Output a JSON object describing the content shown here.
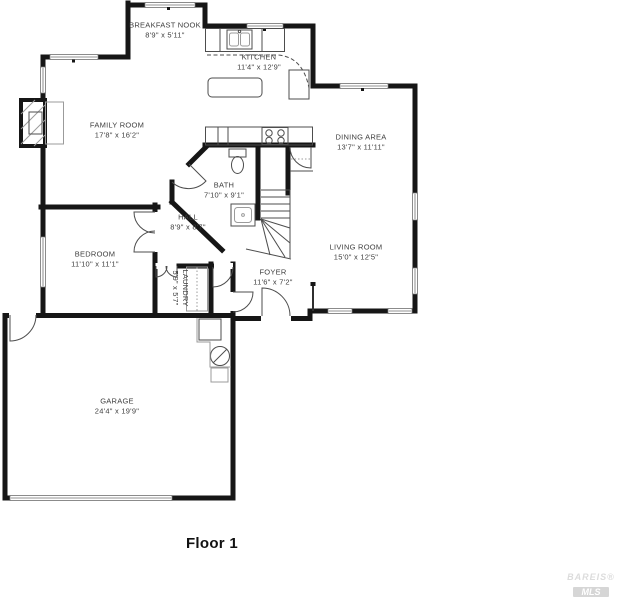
{
  "title": "Floor 1",
  "watermark": {
    "line1": "BAREIS®",
    "line2": "MLS"
  },
  "colors": {
    "wall": "#161616",
    "thin": "#4d4d4d",
    "light": "#9b9b9b",
    "window_border": "#6f6f6f"
  },
  "rooms": [
    {
      "name": "BREAKFAST NOOK",
      "dims": "8'9\" x 5'11\"",
      "cx": 165,
      "cy": 30,
      "vertical": false
    },
    {
      "name": "KITCHEN",
      "dims": "11'4\" x 12'9\"",
      "cx": 259,
      "cy": 62,
      "vertical": false
    },
    {
      "name": "FAMILY ROOM",
      "dims": "17'8\" x 16'2\"",
      "cx": 117,
      "cy": 130,
      "vertical": false
    },
    {
      "name": "DINING AREA",
      "dims": "13'7\" x 11'11\"",
      "cx": 361,
      "cy": 142,
      "vertical": false
    },
    {
      "name": "BATH",
      "dims": "7'10\" x 9'1\"",
      "cx": 224,
      "cy": 190,
      "vertical": false
    },
    {
      "name": "HALL",
      "dims": "8'9\" x 8'7\"",
      "cx": 188,
      "cy": 222,
      "vertical": false
    },
    {
      "name": "BEDROOM",
      "dims": "11'10\" x 11'1\"",
      "cx": 95,
      "cy": 259,
      "vertical": false
    },
    {
      "name": "LIVING ROOM",
      "dims": "15'0\" x 12'5\"",
      "cx": 356,
      "cy": 252,
      "vertical": false
    },
    {
      "name": "FOYER",
      "dims": "11'6\" x 7'2\"",
      "cx": 273,
      "cy": 277,
      "vertical": false
    },
    {
      "name": "LAUNDRY",
      "dims": "5'9\" x 5'7\"",
      "cx": 180,
      "cy": 288,
      "vertical": true
    },
    {
      "name": "GARAGE",
      "dims": "24'4\" x 19'9\"",
      "cx": 117,
      "cy": 406,
      "vertical": false
    }
  ],
  "floorplan": {
    "shapes": [
      {
        "k": "pl",
        "c": "wall",
        "p": "128,5 205,5 205,26 313,26 313,86 415,86 415,311 310,311 310,318.5 233,318.5"
      },
      {
        "k": "pl",
        "c": "wall",
        "p": "233,318.5 233,498 5,498 5,315.5 233,315.5"
      },
      {
        "k": "pl",
        "c": "wall",
        "p": "128,3 128,57 43,57 43,315"
      },
      {
        "k": "ln",
        "c": "wall",
        "x1": 41,
        "y1": 207,
        "x2": 158,
        "y2": 207
      },
      {
        "k": "ln",
        "c": "wall",
        "x1": 155,
        "y1": 205,
        "x2": 155,
        "y2": 212
      },
      {
        "k": "ln",
        "c": "wall",
        "x1": 155,
        "y1": 252,
        "x2": 155,
        "y2": 315
      },
      {
        "k": "ln",
        "c": "wall",
        "x1": 177,
        "y1": 266,
        "x2": 213,
        "y2": 266
      },
      {
        "k": "ln",
        "c": "wall",
        "x1": 211,
        "y1": 264,
        "x2": 211,
        "y2": 315
      },
      {
        "k": "ln",
        "c": "wall",
        "x1": 233,
        "y1": 264,
        "x2": 233,
        "y2": 318
      },
      {
        "k": "ln",
        "c": "wall",
        "x1": 205,
        "y1": 145,
        "x2": 313,
        "y2": 145
      },
      {
        "k": "ln",
        "c": "wall",
        "x1": 258,
        "y1": 145,
        "x2": 258,
        "y2": 218
      },
      {
        "k": "ln",
        "c": "wall",
        "x1": 288,
        "y1": 145,
        "x2": 288,
        "y2": 193
      },
      {
        "k": "ln",
        "c": "wall",
        "x1": 206,
        "y1": 147,
        "x2": 189,
        "y2": 164
      },
      {
        "k": "ln",
        "c": "wall",
        "x1": 172,
        "y1": 182,
        "x2": 172,
        "y2": 202
      },
      {
        "k": "ln",
        "c": "wall",
        "x1": 172,
        "y1": 202,
        "x2": 222,
        "y2": 250
      },
      {
        "k": "wh",
        "x": 261,
        "y": 315,
        "w": 30,
        "h": 7
      },
      {
        "k": "wh",
        "x": 9,
        "y": 312,
        "w": 27,
        "h": 7
      },
      {
        "k": "wh",
        "x": 152,
        "y": 212,
        "w": 6,
        "h": 40
      },
      {
        "k": "wh",
        "x": 155.5,
        "y": 263,
        "w": 21,
        "h": 6
      },
      {
        "k": "wh",
        "x": 214,
        "y": 263,
        "w": 19,
        "h": 6
      },
      {
        "k": "wh",
        "x": 230,
        "y": 292,
        "w": 6,
        "h": 19
      },
      {
        "k": "wn",
        "x": 145,
        "y": 2.5,
        "w": 50,
        "h": 5
      },
      {
        "k": "wn",
        "x": 247,
        "y": 23.5,
        "w": 36,
        "h": 5
      },
      {
        "k": "wn",
        "x": 340,
        "y": 83.5,
        "w": 48,
        "h": 5
      },
      {
        "k": "wn",
        "x": 412.5,
        "y": 193,
        "w": 5,
        "h": 27
      },
      {
        "k": "wn",
        "x": 412.5,
        "y": 268,
        "w": 5,
        "h": 26
      },
      {
        "k": "wn",
        "x": 328,
        "y": 308.5,
        "w": 24,
        "h": 5
      },
      {
        "k": "wn",
        "x": 388,
        "y": 308.5,
        "w": 24,
        "h": 5
      },
      {
        "k": "wn",
        "x": 50,
        "y": 54.5,
        "w": 48,
        "h": 5
      },
      {
        "k": "wn",
        "x": 40.5,
        "y": 67,
        "w": 5,
        "h": 26
      },
      {
        "k": "wn",
        "x": 40.5,
        "y": 237,
        "w": 5,
        "h": 50
      },
      {
        "k": "wn",
        "x": 10,
        "y": 495.5,
        "w": 162,
        "h": 5
      },
      {
        "k": "rc",
        "c": "blk",
        "x": 167,
        "y": 7,
        "w": 3,
        "h": 3
      },
      {
        "k": "rc",
        "c": "blk",
        "x": 72,
        "y": 59.5,
        "w": 3,
        "h": 3
      },
      {
        "k": "rc",
        "c": "blk",
        "x": 263,
        "y": 28,
        "w": 3,
        "h": 3
      },
      {
        "k": "rc",
        "c": "blk",
        "x": 361,
        "y": 88,
        "w": 3,
        "h": 3
      },
      {
        "k": "pa",
        "c": "thin",
        "d": "M262,316 L262,288 A28,28 0 0 1 290,316"
      },
      {
        "k": "pa",
        "c": "thin",
        "d": "M10,315 L10,341 A26,26 0 0 0 36,315"
      },
      {
        "k": "pa",
        "c": "thin",
        "d": "M155,212 L134,212 A21,21 0 0 0 155,233"
      },
      {
        "k": "pa",
        "c": "thin",
        "d": "M155,252 L134,252 A21,21 0 0 1 155,231"
      },
      {
        "k": "pa",
        "c": "thin",
        "d": "M156,266 L156,277 A11,11 0 0 0 167,266"
      },
      {
        "k": "pa",
        "c": "thin",
        "d": "M177,266 L177,277 A11,11 0 0 1 166,266"
      },
      {
        "k": "pa",
        "c": "thin",
        "d": "M213,267 L213,287 A20,20 0 0 0 233,267"
      },
      {
        "k": "pa",
        "c": "thin",
        "d": "M233,292 L253,292 A20,20 0 0 1 233,312"
      },
      {
        "k": "pa",
        "c": "thin",
        "d": "M189,164 L206,181 A24,24 0 0 1 172,182"
      },
      {
        "k": "pa",
        "c": "thin",
        "d": "M311,147 L311,168 A21,21 0 0 1 290,147"
      },
      {
        "k": "ln",
        "c": "thin",
        "x1": 261,
        "y1": 190,
        "x2": 290,
        "y2": 190
      },
      {
        "k": "ln",
        "c": "thin",
        "x1": 261,
        "y1": 197,
        "x2": 290,
        "y2": 197
      },
      {
        "k": "ln",
        "c": "thin",
        "x1": 261,
        "y1": 204,
        "x2": 290,
        "y2": 204
      },
      {
        "k": "ln",
        "c": "thin",
        "x1": 261,
        "y1": 211,
        "x2": 290,
        "y2": 211
      },
      {
        "k": "ln",
        "c": "thin",
        "x1": 261,
        "y1": 218,
        "x2": 290,
        "y2": 218
      },
      {
        "k": "ln",
        "c": "thin",
        "x1": 290,
        "y1": 190,
        "x2": 290,
        "y2": 258
      },
      {
        "k": "ln",
        "c": "thin",
        "x1": 246,
        "y1": 249,
        "x2": 291,
        "y2": 259
      },
      {
        "k": "ln",
        "c": "thin",
        "x1": 261,
        "y1": 219,
        "x2": 290,
        "y2": 228
      },
      {
        "k": "ln",
        "c": "thin",
        "x1": 261,
        "y1": 219,
        "x2": 290,
        "y2": 243
      },
      {
        "k": "ln",
        "c": "thin",
        "x1": 261,
        "y1": 219,
        "x2": 285,
        "y2": 257
      },
      {
        "k": "ln",
        "c": "thin",
        "x1": 261,
        "y1": 219,
        "x2": 270,
        "y2": 255
      },
      {
        "k": "ln",
        "c": "thin",
        "x1": 290,
        "y1": 171,
        "x2": 313,
        "y2": 171
      },
      {
        "k": "ln",
        "c": "dot",
        "x1": 291,
        "y1": 159,
        "x2": 312,
        "y2": 159
      },
      {
        "k": "ln",
        "c": "med",
        "x1": 313,
        "y1": 285,
        "x2": 313,
        "y2": 311
      },
      {
        "k": "rc",
        "c": "blk",
        "x": 310.5,
        "y": 282,
        "w": 5,
        "h": 4
      },
      {
        "k": "rc",
        "c": "thin",
        "x": 205.5,
        "y": 28.5,
        "w": 79,
        "h": 23
      },
      {
        "k": "ln",
        "c": "thin",
        "x1": 220,
        "y1": 28.5,
        "x2": 220,
        "y2": 51.5
      },
      {
        "k": "ln",
        "c": "thin",
        "x1": 262,
        "y1": 28.5,
        "x2": 262,
        "y2": 51.5
      },
      {
        "k": "rc",
        "c": "thin",
        "x": 227,
        "y": 30,
        "w": 25,
        "h": 19
      },
      {
        "k": "rc",
        "c": "light",
        "x": 229.5,
        "y": 33,
        "w": 9,
        "h": 13,
        "rx": 2
      },
      {
        "k": "rc",
        "c": "light",
        "x": 240.5,
        "y": 33,
        "w": 9,
        "h": 13,
        "rx": 2
      },
      {
        "k": "ci",
        "c": "thin",
        "cx": 239.5,
        "cy": 31.5,
        "r": 1.2
      },
      {
        "k": "pa",
        "c": "dash",
        "d": "M207,55 L278,55 Q303,57 309,88"
      },
      {
        "k": "rc",
        "c": "thin",
        "x": 289,
        "y": 70,
        "w": 20,
        "h": 29
      },
      {
        "k": "rc",
        "c": "thin",
        "x": 208,
        "y": 78,
        "w": 54,
        "h": 19,
        "rx": 4
      },
      {
        "k": "rc",
        "c": "thin",
        "x": 205.5,
        "y": 127,
        "w": 107,
        "h": 18
      },
      {
        "k": "ln",
        "c": "thin",
        "x1": 218,
        "y1": 127,
        "x2": 218,
        "y2": 145
      },
      {
        "k": "ln",
        "c": "thin",
        "x1": 228,
        "y1": 127,
        "x2": 228,
        "y2": 145
      },
      {
        "k": "rc",
        "c": "thin",
        "x": 262,
        "y": 127.5,
        "w": 26,
        "h": 17
      },
      {
        "k": "ci",
        "c": "thin",
        "cx": 269,
        "cy": 133,
        "r": 3.2
      },
      {
        "k": "ci",
        "c": "thin",
        "cx": 281,
        "cy": 133,
        "r": 3.2
      },
      {
        "k": "ci",
        "c": "thin",
        "cx": 269,
        "cy": 140.5,
        "r": 3.2
      },
      {
        "k": "ci",
        "c": "thin",
        "cx": 281,
        "cy": 140.5,
        "r": 3.2
      },
      {
        "k": "rc",
        "c": "thin",
        "x": 229,
        "y": 149,
        "w": 17,
        "h": 8
      },
      {
        "k": "el",
        "c": "thin",
        "cx": 237.5,
        "cy": 165,
        "rx": 6,
        "ry": 8.5
      },
      {
        "k": "rc",
        "c": "thin",
        "x": 231,
        "y": 204,
        "w": 24,
        "h": 22
      },
      {
        "k": "rc",
        "c": "light",
        "x": 234.5,
        "y": 207.5,
        "w": 17,
        "h": 15,
        "rx": 3
      },
      {
        "k": "ci",
        "c": "light",
        "cx": 243,
        "cy": 215,
        "r": 1.4
      },
      {
        "k": "rc",
        "c": "light",
        "x": 186.5,
        "y": 267,
        "w": 21,
        "h": 44
      },
      {
        "k": "ln",
        "c": "dot",
        "x1": 197,
        "y1": 267,
        "x2": 197,
        "y2": 311
      },
      {
        "k": "rc",
        "c": "wall4",
        "x": 21,
        "y": 100,
        "w": 24,
        "h": 46
      },
      {
        "k": "ln",
        "c": "light",
        "x1": 21,
        "y1": 114,
        "x2": 35,
        "y2": 100
      },
      {
        "k": "ln",
        "c": "light",
        "x1": 21,
        "y1": 129,
        "x2": 45,
        "y2": 105
      },
      {
        "k": "ln",
        "c": "light",
        "x1": 21,
        "y1": 144,
        "x2": 45,
        "y2": 120
      },
      {
        "k": "ln",
        "c": "light",
        "x1": 34,
        "y1": 146,
        "x2": 45,
        "y2": 135
      },
      {
        "k": "rc",
        "c": "thin",
        "x": 29,
        "y": 112,
        "w": 13,
        "h": 22
      },
      {
        "k": "rc",
        "c": "light",
        "x": 45.5,
        "y": 102,
        "w": 18,
        "h": 42
      },
      {
        "k": "rc",
        "c": "thin",
        "x": 199,
        "y": 319,
        "w": 22,
        "h": 21
      },
      {
        "k": "ci",
        "c": "thin",
        "cx": 220,
        "cy": 356,
        "r": 9.5
      },
      {
        "k": "ln",
        "c": "thin",
        "x1": 213,
        "y1": 363,
        "x2": 227,
        "y2": 349
      },
      {
        "k": "rc",
        "c": "light",
        "x": 211,
        "y": 368,
        "w": 17,
        "h": 14
      },
      {
        "k": "pl",
        "c": "light",
        "p": "197,318 197,342 210,342 210,367 231,367"
      }
    ]
  }
}
